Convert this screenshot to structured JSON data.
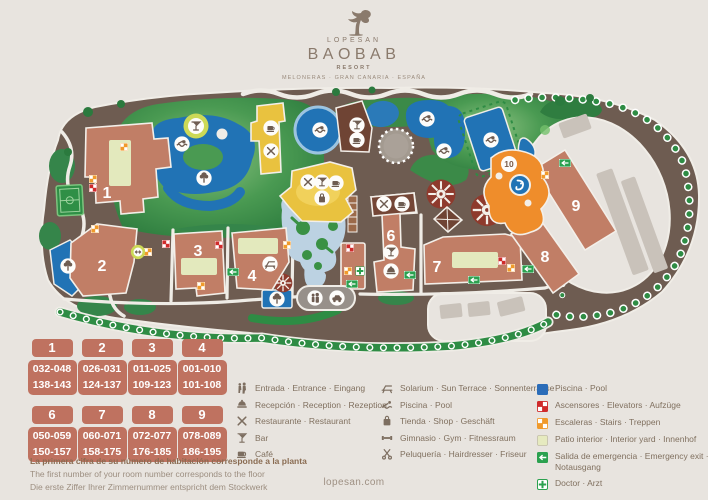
{
  "logo": {
    "brand": "LOPESAN",
    "name": "BAOBAB",
    "type": "RESORT",
    "location": "MELONERAS · GRAN CANARIA · ESPAÑA"
  },
  "map_labels": {
    "b1": "1",
    "b2": "2",
    "b3": "3",
    "b4": "4",
    "b6": "6",
    "b7": "7",
    "b8": "8",
    "b9": "9",
    "b10": "10"
  },
  "room_boxes": [
    {
      "number": "1",
      "range1": "032-048",
      "range2": "138-143"
    },
    {
      "number": "2",
      "range1": "026-031",
      "range2": "124-137"
    },
    {
      "number": "3",
      "range1": "011-025",
      "range2": "109-123"
    },
    {
      "number": "4",
      "range1": "001-010",
      "range2": "101-108"
    },
    {
      "number": "6",
      "range1": "050-059",
      "range2": "150-157"
    },
    {
      "number": "7",
      "range1": "060-071",
      "range2": "158-175"
    },
    {
      "number": "8",
      "range1": "072-077",
      "range2": "176-185"
    },
    {
      "number": "9",
      "range1": "078-089",
      "range2": "186-195"
    }
  ],
  "floor_note": {
    "es": "La primera cifra de su número de habitación corresponde a la planta",
    "en": "The first number of your room number corresponds to the floor",
    "de": "Die erste Ziffer Ihrer Zimmernummer entspricht dem Stockwerk"
  },
  "legend": {
    "column1": [
      {
        "icon": "entrance-icon",
        "label": "Entrada · Entrance · Eingang"
      },
      {
        "icon": "reception-icon",
        "label": "Recepción · Reception · Rezeption"
      },
      {
        "icon": "restaurant-icon",
        "label": "Restaurante · Restaurant"
      },
      {
        "icon": "bar-icon",
        "label": "Bar"
      },
      {
        "icon": "cafe-icon",
        "label": "Café"
      }
    ],
    "column2": [
      {
        "icon": "solarium-icon",
        "label": "Solarium · Sun Terrace · Sonnenterrasse"
      },
      {
        "icon": "pool-icon",
        "label": "Piscina · Pool"
      },
      {
        "icon": "shop-icon",
        "label": "Tienda · Shop · Geschäft"
      },
      {
        "icon": "gym-icon",
        "label": "Gimnasio · Gym · Fitnessraum"
      },
      {
        "icon": "hairdresser-icon",
        "label": "Peluquería · Hairdresser · Friseur"
      }
    ],
    "column3": [
      {
        "swatch": "pool",
        "color": "#2b6cb8",
        "label": "Piscina · Pool"
      },
      {
        "swatch": "elevators",
        "color": "#cf2b2b",
        "label": "Ascensores · Elevators · Aufzüge"
      },
      {
        "swatch": "stairs",
        "color": "#f09a2b",
        "label": "Escaleras · Stairs · Treppen"
      },
      {
        "swatch": "patio",
        "color": "#e6eabf",
        "label": "Patio interior · Interior yard · Innenhof"
      },
      {
        "swatch": "emergency",
        "color": "#2ba14f",
        "label": "Salida de emergencia · Emergency exit · Notausgang"
      },
      {
        "swatch": "doctor",
        "color": "#2ba14f",
        "label": "Doctor · Arzt"
      }
    ]
  },
  "footer": {
    "website": "lopesan.com"
  }
}
